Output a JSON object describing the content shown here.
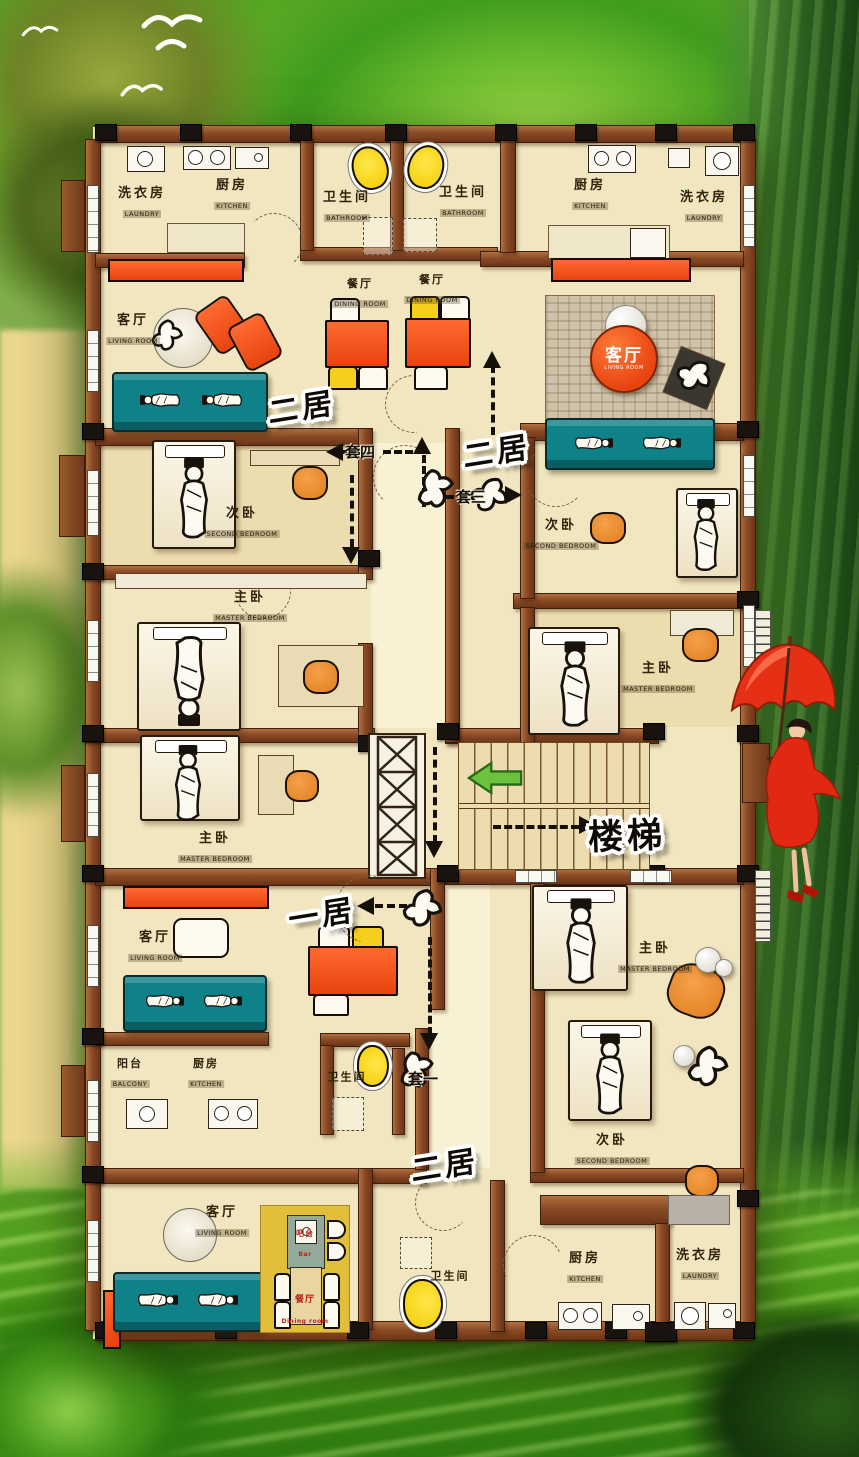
{
  "title": "residential floor plan poster",
  "palette": {
    "wall_brown": "#8a4a26",
    "floor_beige": "#f1e6bf",
    "sofa_teal": "#0f8289",
    "furniture_orange": "#ee5a22",
    "chair_orange": "#e48a2d",
    "toilet_yellow": "#f2cc00",
    "stair_arrow_green": "#6cc23e",
    "background_green": "#56a623",
    "umbrella_red": "#e63015"
  },
  "rooms": [
    {
      "zh": "洗衣房",
      "en": "LAUNDRY"
    },
    {
      "zh": "厨房",
      "en": "KITCHEN"
    },
    {
      "zh": "卫生间",
      "en": "BATHROOM"
    },
    {
      "zh": "卫生间",
      "en": "BATHROOM"
    },
    {
      "zh": "餐厅",
      "en": "DINING ROOM"
    },
    {
      "zh": "餐厅",
      "en": "DINING ROOM"
    },
    {
      "zh": "客厅",
      "en": "LIVING ROOM"
    },
    {
      "zh": "厨房",
      "en": "KITCHEN"
    },
    {
      "zh": "洗衣房",
      "en": "LAUNDRY"
    },
    {
      "zh": "客厅",
      "en": "LIVING ROOM"
    },
    {
      "zh": "次卧",
      "en": "SECOND BEDROOM"
    },
    {
      "zh": "次卧",
      "en": "SECOND BEDROOM"
    },
    {
      "zh": "主卧",
      "en": "MASTER BEDROOM"
    },
    {
      "zh": "主卧",
      "en": "MASTER BEDROOM"
    },
    {
      "zh": "主卧",
      "en": "MASTER BEDROOM"
    },
    {
      "zh": "客厅",
      "en": "LIVING ROOM"
    },
    {
      "zh": "阳台",
      "en": "BALCONY"
    },
    {
      "zh": "厨房",
      "en": "KITCHEN"
    },
    {
      "zh": "卫生间",
      "en": ""
    },
    {
      "zh": "主卧",
      "en": "MASTER BEDROOM"
    },
    {
      "zh": "次卧",
      "en": "SECOND BEDROOM"
    },
    {
      "zh": "客厅",
      "en": "LIVING ROOM"
    },
    {
      "zh": "吧台",
      "en": "Bar"
    },
    {
      "zh": "餐厅",
      "en": "Dining room"
    },
    {
      "zh": "卫生间",
      "en": ""
    },
    {
      "zh": "厨房",
      "en": "KITCHEN"
    },
    {
      "zh": "洗衣房",
      "en": "LAUNDRY"
    }
  ],
  "unit_labels": [
    {
      "text": "二居"
    },
    {
      "text": "二居"
    },
    {
      "text": "一居"
    },
    {
      "text": "二居"
    }
  ],
  "stairs_label": "楼梯",
  "suite_labels": [
    {
      "text": "套四"
    },
    {
      "text": "套三"
    },
    {
      "text": "套一"
    }
  ]
}
